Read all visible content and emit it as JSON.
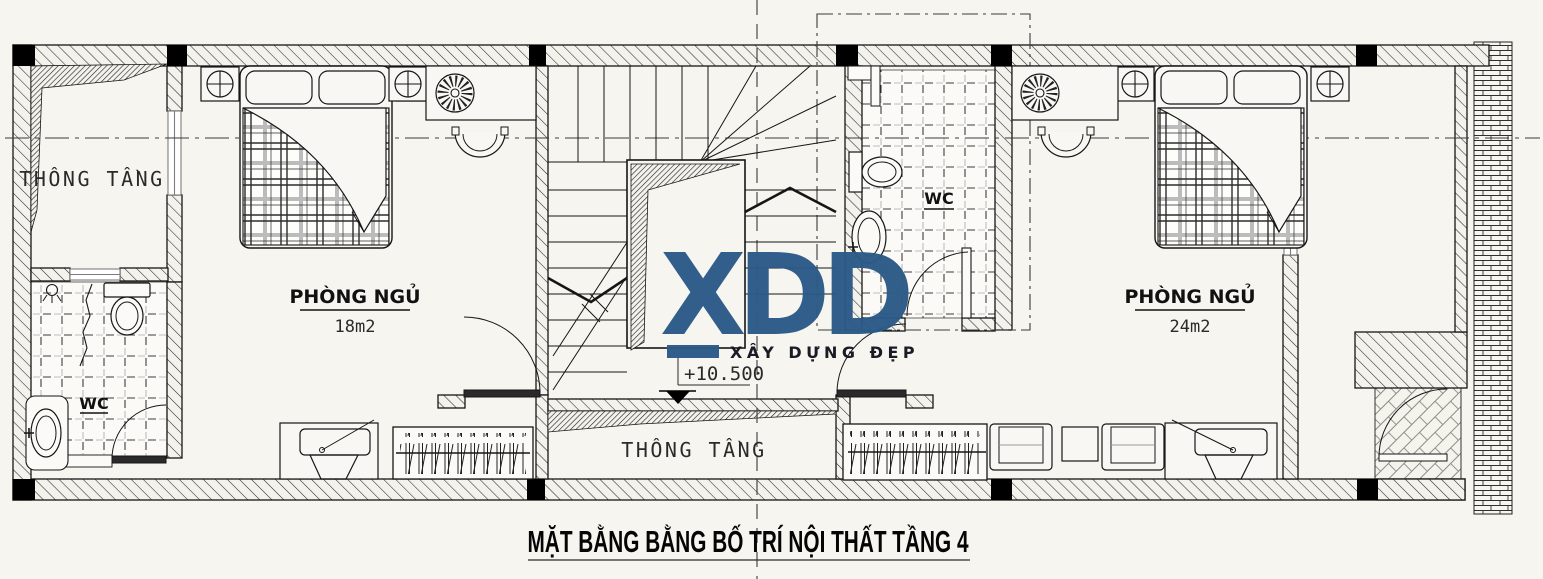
{
  "drawing": {
    "title": "MẶT BẰNG BẰNG BỐ TRÍ NỘI THẤT TẦNG 4",
    "level_mark": "+10.500"
  },
  "rooms": {
    "void_top_left": {
      "label": "THÔNG TẦNG"
    },
    "void_bottom": {
      "label": "THÔNG TẦNG"
    },
    "bedroom_left": {
      "label": "PHÒNG NGỦ",
      "area": "18m2"
    },
    "bedroom_right": {
      "label": "PHÒNG NGỦ",
      "area": "24m2"
    },
    "wc_left": {
      "label": "WC"
    },
    "wc_middle": {
      "label": "WC"
    }
  },
  "watermark": {
    "logo": "XDD",
    "tagline": "XÂY DỰNG ĐẸP",
    "logo_color": "#2b5a87",
    "tagline_color": "#12141f"
  },
  "colors": {
    "background": "#f6f5f0",
    "line": "#1a1a1a",
    "hatch": "#2b2b2b",
    "tile_gray": "#bdbdbd"
  },
  "furniture_counts": {
    "beds": 2,
    "wardrobes": 2,
    "desks": 2,
    "armchairs": 2,
    "toilets": 2,
    "sinks": 2,
    "ceiling_fans": 2,
    "night_lamps": 5
  }
}
